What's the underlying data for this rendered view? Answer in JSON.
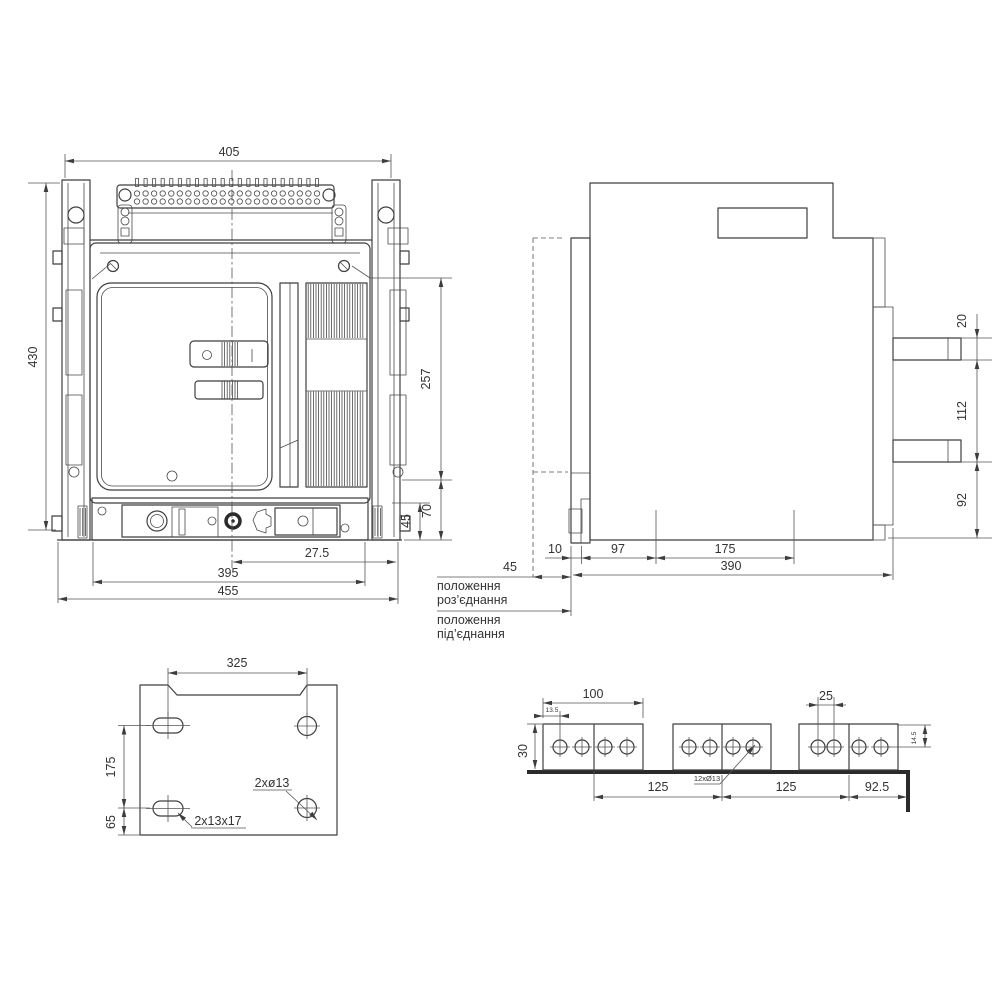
{
  "drawing": {
    "background": "#ffffff",
    "line_color": "#3f3f3f",
    "text_color": "#333333"
  },
  "front_view": {
    "dims": {
      "overall_width": "405",
      "overall_height": "430",
      "body_height": "257",
      "base_height": "70",
      "base_inner": "45",
      "center_offset": "27.5",
      "inner_width": "395",
      "total_width": "455"
    }
  },
  "side_view": {
    "dims": {
      "busbar_thickness": "20",
      "busbar_spacing": "112",
      "busbar_bottom": "92",
      "front_gap": "10",
      "hole_offset": "97",
      "hole_spacing": "175",
      "depth": "390",
      "travel": "45"
    },
    "labels": {
      "disconnect_1": "положення",
      "disconnect_2": "роз’єднання",
      "connect_1": "положення",
      "connect_2": "під’єднання"
    }
  },
  "mounting_plate": {
    "dims": {
      "cutout_width": "325",
      "hole_spacing": "175",
      "edge_offset": "65"
    },
    "labels": {
      "round_holes": "2xø13",
      "slot_holes": "2x13x17"
    }
  },
  "busbar_view": {
    "dims": {
      "pad_width": "100",
      "hole_edge": "13.5",
      "bar_width": "30",
      "hole_pitch": "25",
      "hole_top": "14.5",
      "pitch_1": "125",
      "pitch_2": "125",
      "end_offset": "92.5"
    },
    "labels": {
      "holes": "12xØ13"
    }
  }
}
